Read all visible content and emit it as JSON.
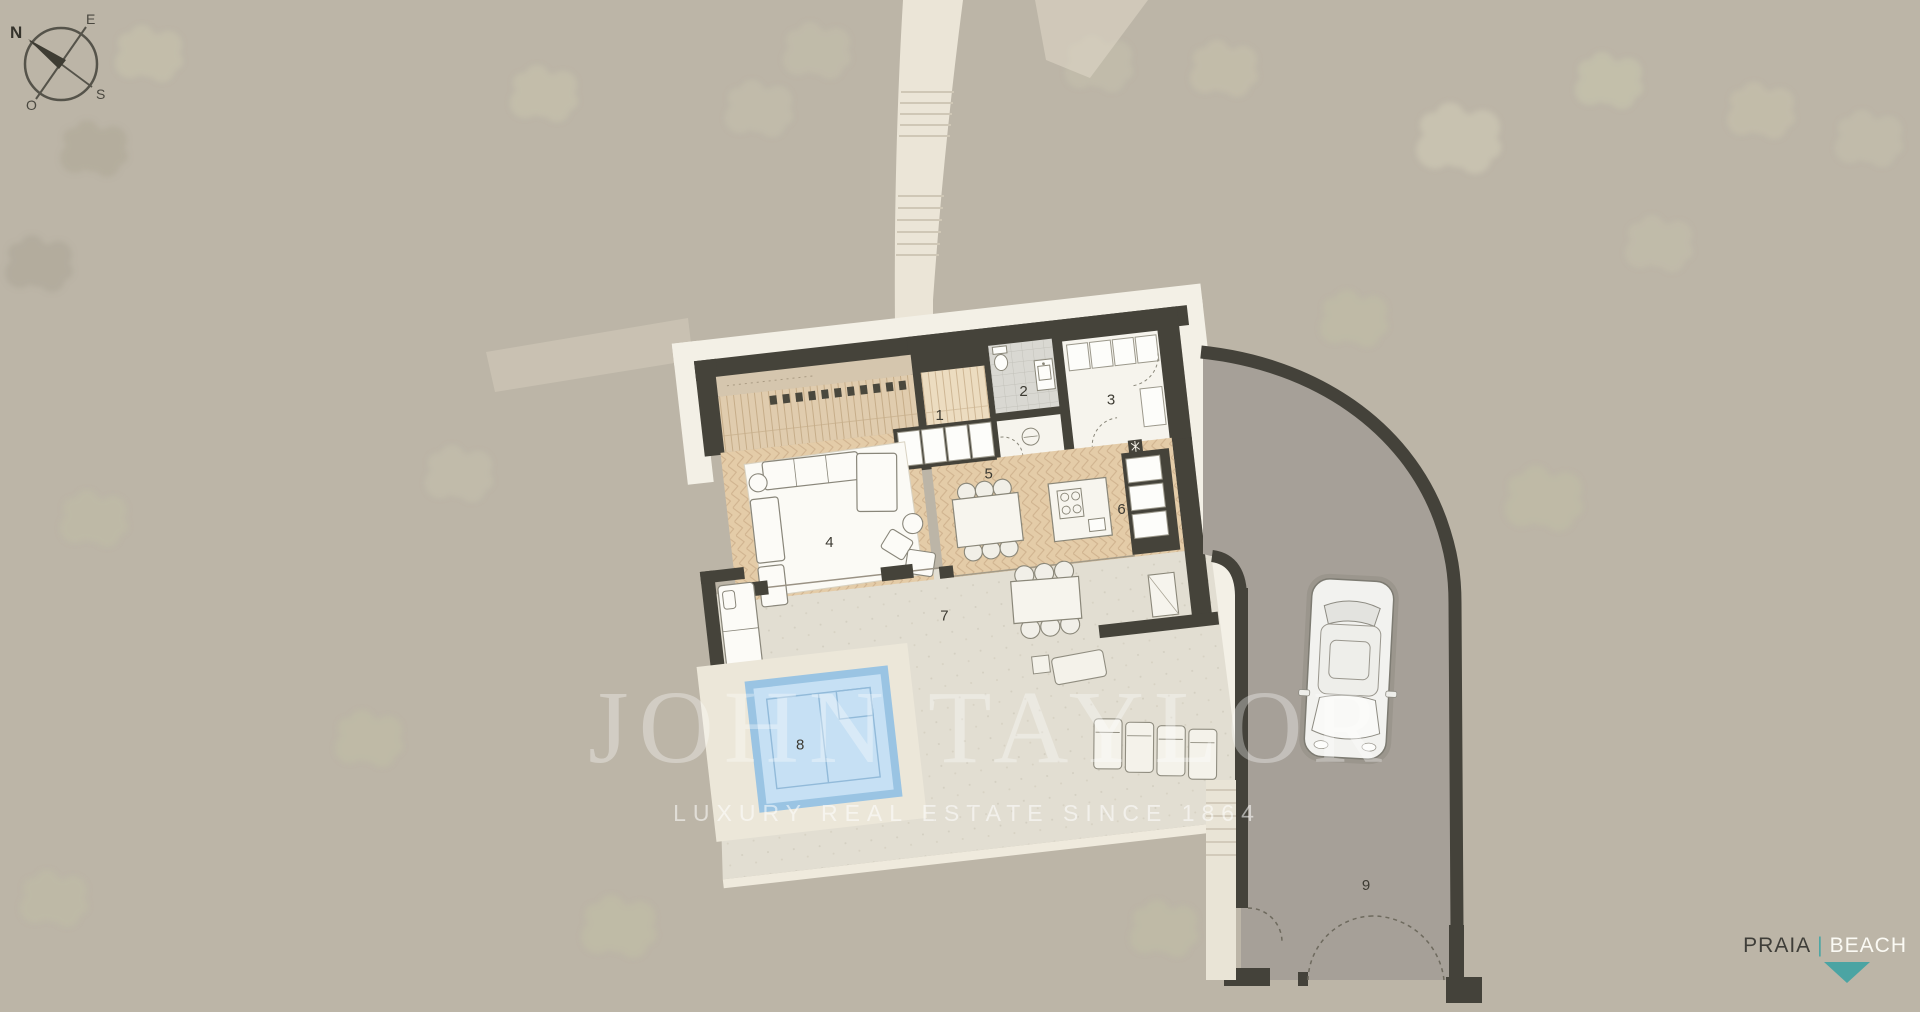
{
  "compass": {
    "north": "N",
    "east": "E",
    "south": "S",
    "west": "O"
  },
  "plan": {
    "room_labels": [
      {
        "number": "1"
      },
      {
        "number": "2"
      },
      {
        "number": "3"
      },
      {
        "number": "4"
      },
      {
        "number": "5"
      },
      {
        "number": "6"
      },
      {
        "number": "7"
      },
      {
        "number": "8"
      },
      {
        "number": "9"
      }
    ]
  },
  "watermark": {
    "brand": "JOHN TAYLOR",
    "tagline": "LUXURY REAL ESTATE SINCE 1864"
  },
  "location_badge": {
    "praia": "PRAIA",
    "separator": "|",
    "beach": "BEACH"
  },
  "colors": {
    "background": "#bcb5a7",
    "tree": "#c9c6ae",
    "wall": "#45433a",
    "footpath": "#ebe5d7",
    "white_band": "#f3f0e6",
    "terrace": "#e2ded2",
    "wood_deck": "#e0ccae",
    "herringbone": "#e4cca8",
    "pool_water": "#c6e0f4",
    "pool_edge": "#9ac4e3",
    "driveway": "#a6a098",
    "accent_teal": "#4ba4a3"
  }
}
